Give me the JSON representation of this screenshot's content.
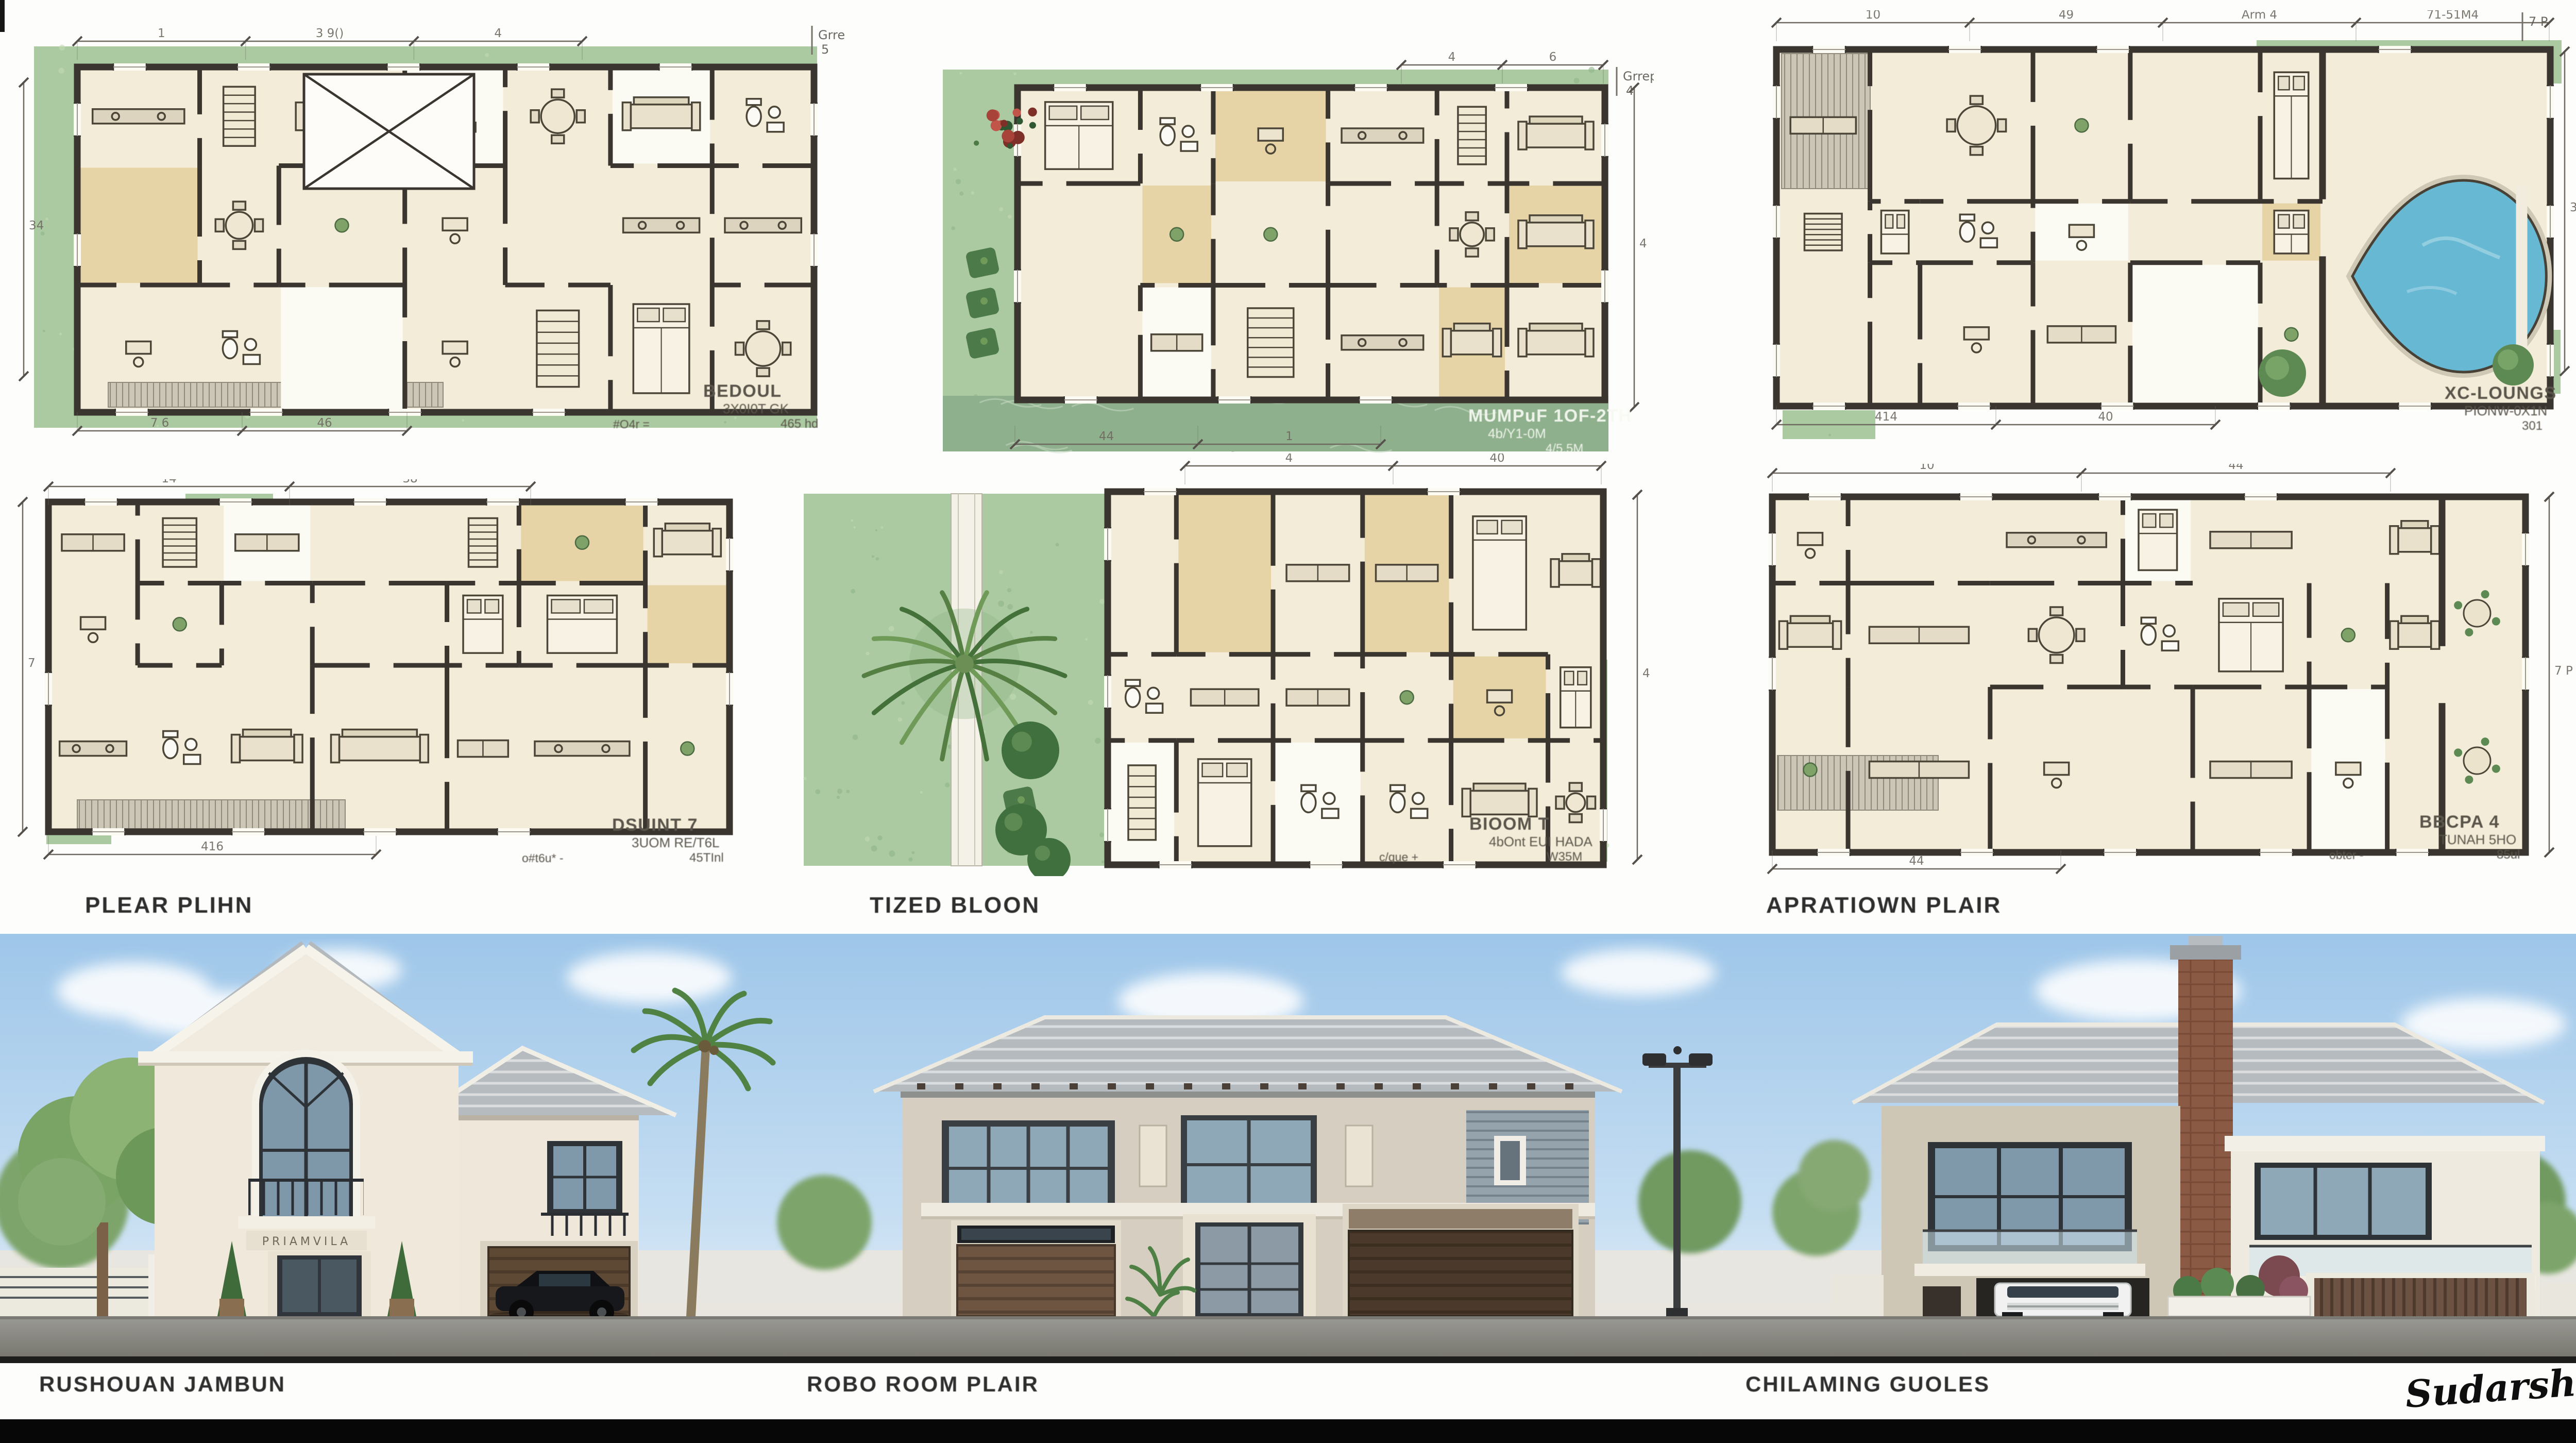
{
  "board": {
    "section_labels": [
      "PLEAR PLIHN",
      "TIZED BLOON",
      "APRATIOWN PLAIR"
    ],
    "elevation_labels": [
      "RUSHOUAN JAMBUN",
      "ROBO ROOM PLAIR",
      "CHILAMING GUOLES"
    ],
    "signature": "Sudarshan K.",
    "house_sign": "PRIAMVILA"
  },
  "plans": [
    {
      "id": "plan-1",
      "ann": {
        "title": "BEDOUL",
        "sub1": "3X0I0T GK",
        "sub2": "465 hd",
        "left": "#O4r ="
      },
      "note": {
        "t1": "Grrep",
        "t2": "5"
      },
      "dim_top": [
        "1",
        "3 9()",
        "4"
      ],
      "dim_bottom": [
        "7 6",
        "46"
      ],
      "dim_side": [
        "34"
      ]
    },
    {
      "id": "plan-2",
      "ann": {
        "title": "MUMPuF 1OF-2TH",
        "sub1": "4b/Y1-0M",
        "sub2": "4/5.5M",
        "left": ""
      },
      "note": {
        "t1": "Grrep",
        "t2": "4"
      },
      "dim_top": [
        "4",
        "6"
      ],
      "dim_bottom": [
        "44",
        "1"
      ],
      "dim_side": [
        "4"
      ]
    },
    {
      "id": "plan-3",
      "ann": {
        "title": "XC-LOUNGS",
        "sub1": "PIONW-0X1N",
        "sub2": "301",
        "left": ""
      },
      "note": {
        "t1": "7 P",
        "t2": ""
      },
      "dim_top": [
        "10",
        "49",
        "Arm 4",
        "71-51M4"
      ],
      "dim_bottom": [
        "414",
        "40"
      ],
      "dim_side": [
        "30"
      ]
    },
    {
      "id": "plan-4",
      "ann": {
        "title": "DSUINT 7",
        "sub1": "3UOM RE/T6L",
        "sub2": "45TInl",
        "left": "o#t6u* -"
      },
      "note": {
        "t1": "",
        "t2": ""
      },
      "dim_top": [
        "14",
        "38"
      ],
      "dim_bottom": [
        "416"
      ],
      "dim_side": [
        "7"
      ]
    },
    {
      "id": "plan-5",
      "ann": {
        "title": "BIOOM T",
        "sub1": "4bOnt EUI HADA",
        "sub2": "W35M",
        "left": "c/que +"
      },
      "note": {
        "t1": "",
        "t2": ""
      },
      "dim_top": [
        "4",
        "40"
      ],
      "dim_bottom": [],
      "dim_side": [
        "4"
      ]
    },
    {
      "id": "plan-6",
      "ann": {
        "title": "BBCPA 4",
        "sub1": "TUNAH 5HO",
        "sub2": "85ul",
        "left": "obter -"
      },
      "note": {
        "t1": "",
        "t2": ""
      },
      "dim_top": [
        "10",
        "44"
      ],
      "dim_bottom": [
        "44"
      ],
      "dim_side": [
        "7 P"
      ]
    }
  ],
  "colors": {
    "lawn": "#abcaa1",
    "lawn_dark": "#8fb487",
    "lawn_light": "#c3dab6",
    "marble_band": "#8fb08d",
    "room_cream": "#f3ecd8",
    "room_white": "#fbfaf3",
    "room_tan": "#e7d4a6",
    "wall_dark": "#3a362f",
    "deck_gray": "#cbc6b6",
    "gray_band": "#a2a09a",
    "pool_blue": "#67b8d2",
    "dim_line": "#6e6960",
    "sky_top": "#9ec6e9",
    "roof_gray": "#b6bbbf",
    "stucco_cream": "#f0e9db",
    "stucco_taupe": "#d6cec0",
    "garage_brown": "#5e4935",
    "brick_chimney": "#8a5a44",
    "street_gray": "#8e8d86",
    "bottom_bar": "#070707"
  }
}
